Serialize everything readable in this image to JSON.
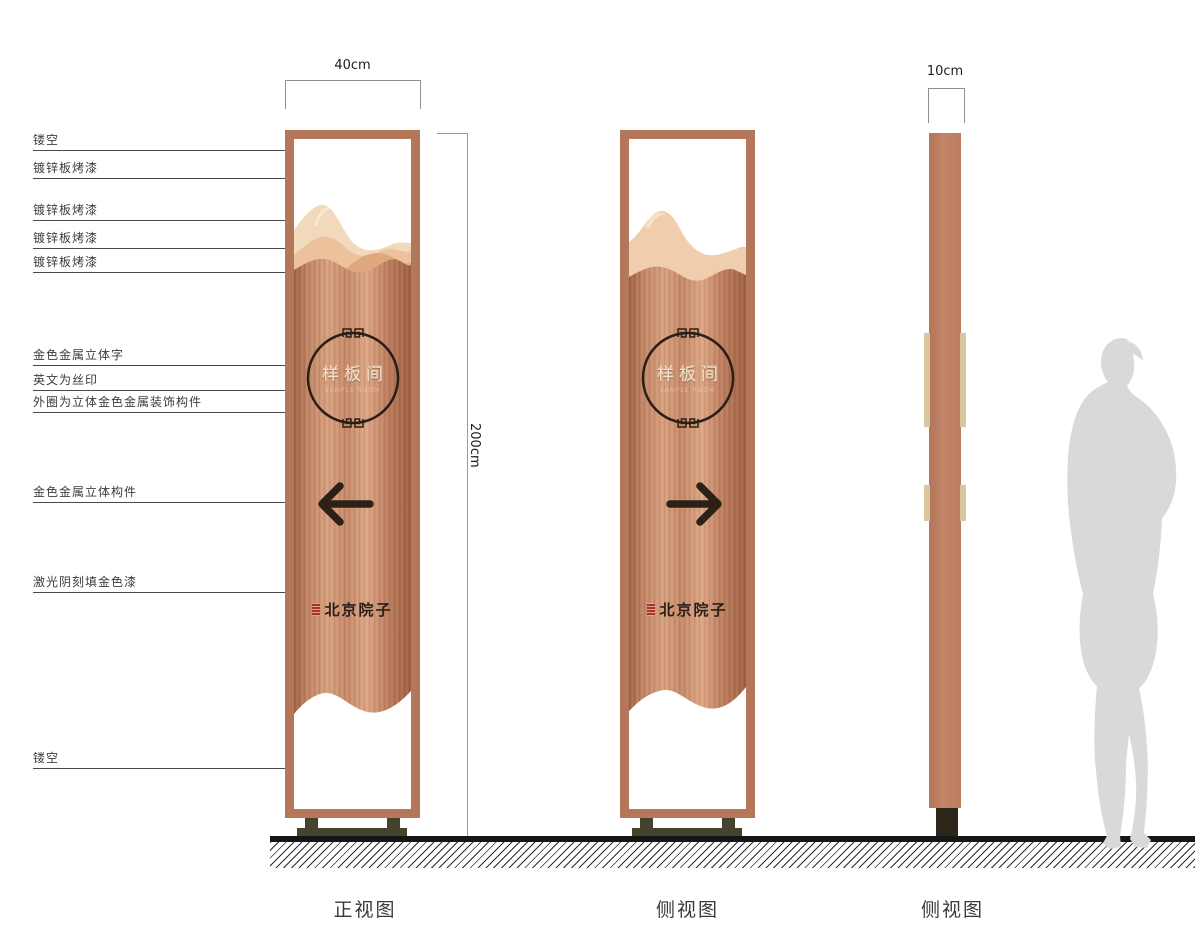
{
  "callouts": [
    "镂空",
    "镀锌板烤漆",
    "镀锌板烤漆",
    "镀锌板烤漆",
    "镀锌板烤漆",
    "金色金属立体字",
    "英文为丝印",
    "外圈为立体金色金属装饰构件",
    "金色金属立体构件",
    "激光阴刻填金色漆",
    "镂空"
  ],
  "dimensions": {
    "front_width": "40cm",
    "total_height": "200cm",
    "side_depth": "10cm"
  },
  "views": {
    "front_caption": "正视图",
    "side_caption": "侧视图",
    "profile_caption": "侧视图"
  },
  "sign": {
    "circle_text": "样板间",
    "circle_subtext": "SAMPLE ROOM",
    "brand_text": "北京院子"
  },
  "colors": {
    "copper_frame": "#b5775a",
    "copper_wood_light": "#d7a07f",
    "copper_wood_dark": "#9e6143",
    "mountain_light": "#f3d9bc",
    "mountain_mid": "#ecc29c",
    "mountain_dark": "#dfa87e",
    "tan_strip": "#d9c69e",
    "base_olive": "#45422d",
    "arrow_dark": "#2c2117",
    "seal_red": "#a93327",
    "silhouette_gray": "#d9d9d9"
  }
}
